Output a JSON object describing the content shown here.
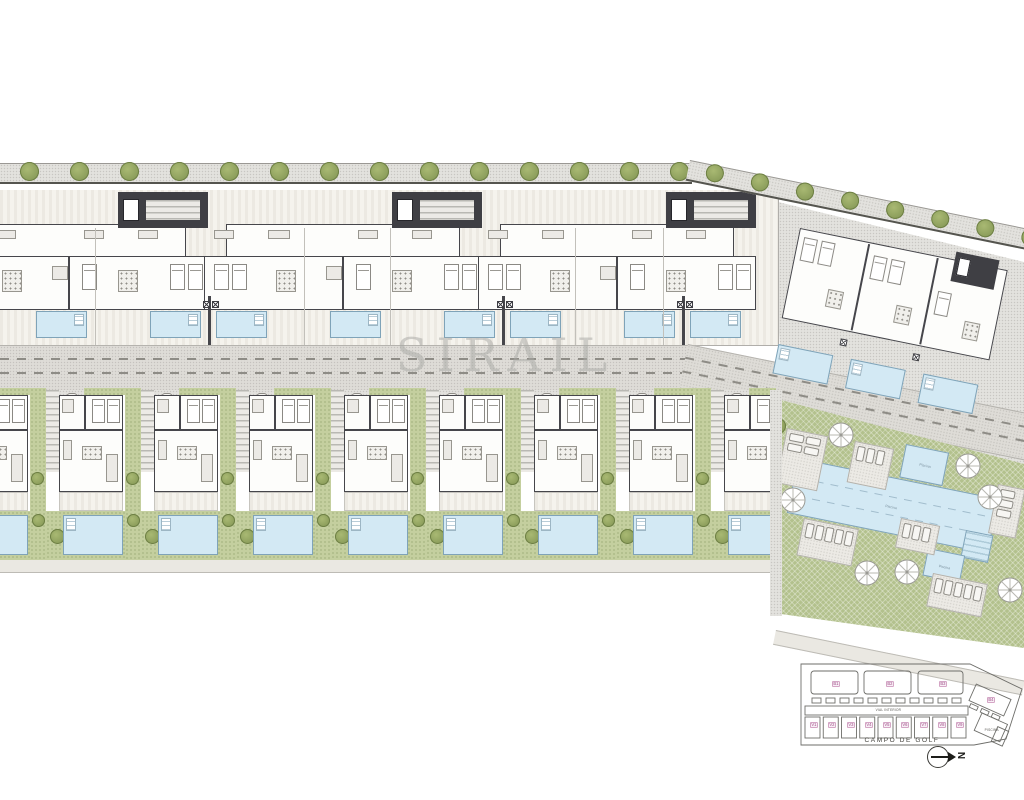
{
  "title": "Residential development site plan",
  "watermark_text": "SIRAIL",
  "labels": {
    "campo_de_golf": "CAMPO DE GOLF",
    "vial_interior": "VIAL INTERIOR",
    "north_letter": "N",
    "main_pool": "Piscina",
    "kids_pool": "Piscina",
    "square_pool": "Piscina",
    "keyplan_pool_area": "PISCINA"
  },
  "keyplan": {
    "block_labels": [
      "B1",
      "B2",
      "B3"
    ],
    "wing_block_label": "B4",
    "villa_labels": [
      "V1",
      "V2",
      "V3",
      "V4",
      "V5",
      "V6",
      "V7",
      "V8",
      "V9"
    ]
  },
  "counts": {
    "apartment_blocks_top_row": 3,
    "angled_block_units": 3,
    "villas_bottom_row": 9,
    "top_row_pools": 8,
    "villa_pools": 9,
    "communal_umbrellas": 7,
    "sun_deck_areas": 6
  },
  "colors": {
    "pool_blue": "#d3e9f4",
    "pool_border": "#7fa3b8",
    "lawn_green": "#b3c18d",
    "hedge_green": "#7e9150",
    "wall_dark": "#46464b",
    "pavement": "#e3e2de",
    "keyplan_label_magenta": "#a14f88",
    "watermark_gray": "#a8a8a4"
  }
}
